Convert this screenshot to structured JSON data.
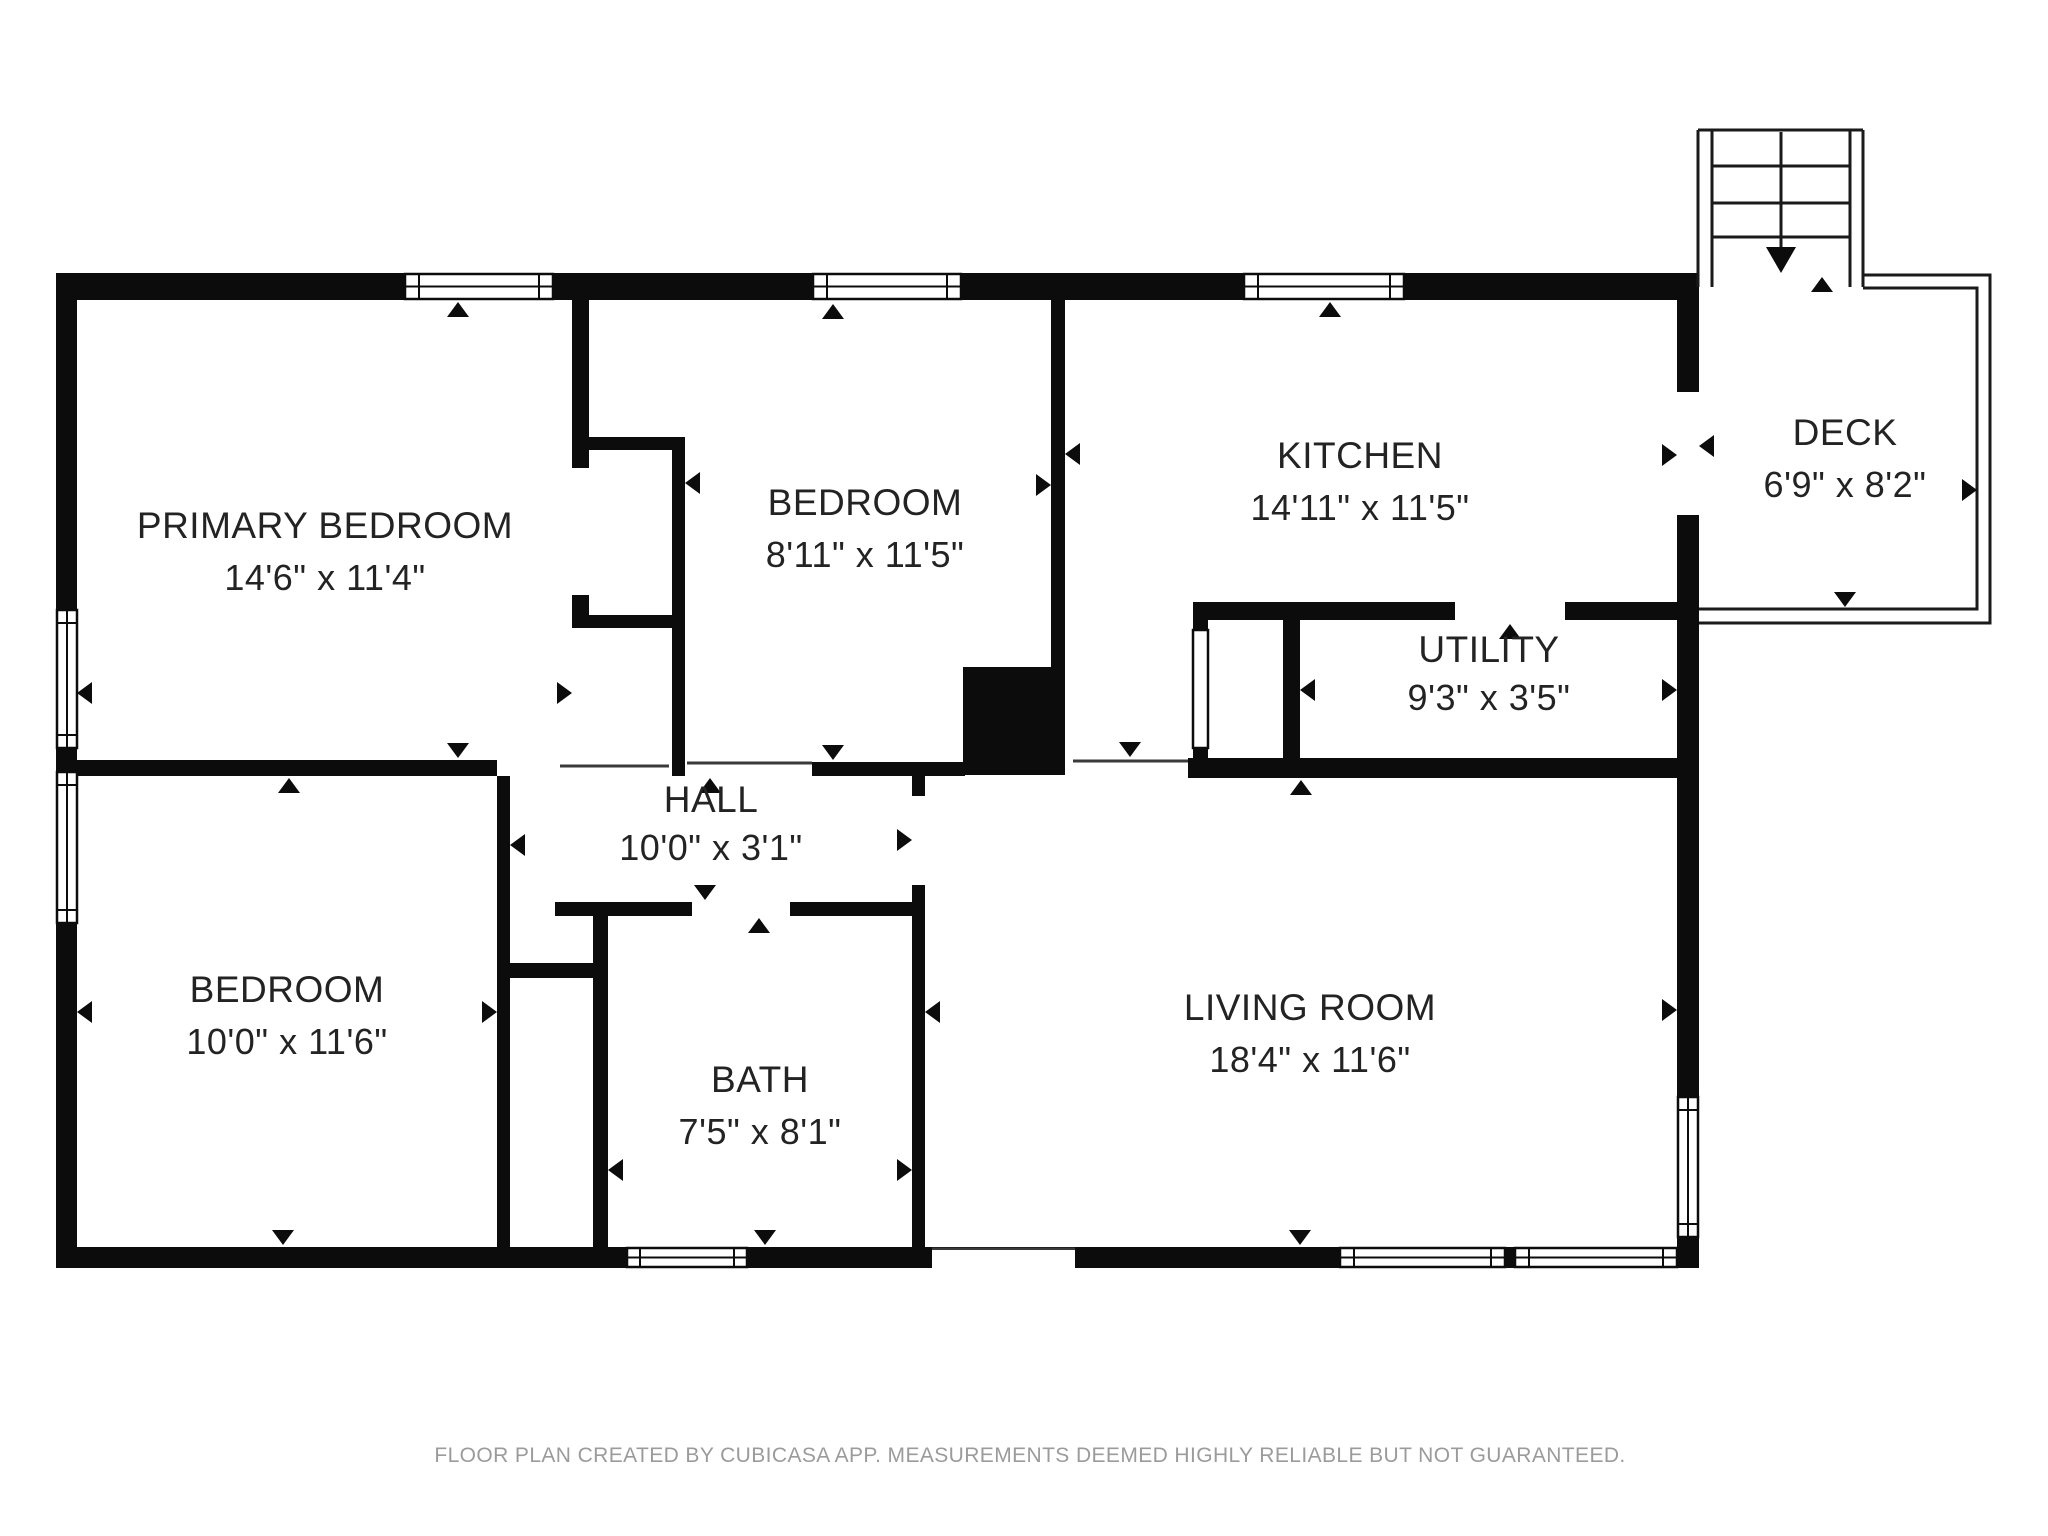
{
  "plan": {
    "type": "floor-plan",
    "creator_note": "FLOOR PLAN CREATED BY CUBICASA APP. MEASUREMENTS DEEMED HIGHLY RELIABLE BUT NOT GUARANTEED."
  },
  "colors": {
    "wall": "#0c0c0c",
    "background": "#ffffff",
    "label": "#232323",
    "footer": "#9b9b9b"
  },
  "rooms": [
    {
      "id": "primary-bedroom",
      "name": "PRIMARY BEDROOM",
      "dims": "14'6\" x 11'4\""
    },
    {
      "id": "bedroom-top",
      "name": "BEDROOM",
      "dims": "8'11\" x 11'5\""
    },
    {
      "id": "kitchen",
      "name": "KITCHEN",
      "dims": "14'11\" x 11'5\""
    },
    {
      "id": "deck",
      "name": "DECK",
      "dims": "6'9\" x 8'2\""
    },
    {
      "id": "utility",
      "name": "UTILITY",
      "dims": "9'3\" x 3'5\""
    },
    {
      "id": "hall",
      "name": "HALL",
      "dims": "10'0\" x 3'1\""
    },
    {
      "id": "bedroom-bottom",
      "name": "BEDROOM",
      "dims": "10'0\" x 11'6\""
    },
    {
      "id": "bath",
      "name": "BATH",
      "dims": "7'5\" x 8'1\""
    },
    {
      "id": "living-room",
      "name": "LIVING ROOM",
      "dims": "18'4\" x 11'6\""
    }
  ]
}
